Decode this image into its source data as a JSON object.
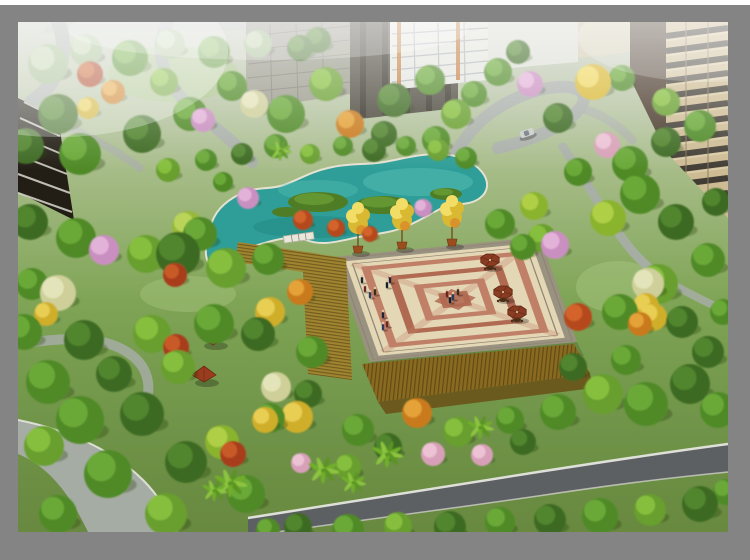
{
  "frame": {
    "background": "#ffffff",
    "matte": "#848484"
  },
  "scene": {
    "palette": {
      "baseTop": "#c6cabe",
      "baseHigh": "#a8bd8a",
      "baseMid": "#7fa455",
      "baseLow": "#6f9348",
      "baseBot": "#68893f",
      "lawn": "#a6c47e",
      "road": "#a9aeaa",
      "roadLight": "#b8bcb6",
      "asphalt": "#5d6062",
      "curb": "#e6e6e0",
      "pond": "#2f9e98",
      "pondLight": "#55bdb4",
      "pondDark": "#1d807c",
      "pondRim": "#e5e2d2",
      "lily": "#4e7d26",
      "lilyLite": "#6a9c34",
      "plazaStep": "#9a9280",
      "plazaCream": "#e4d7b6",
      "plazaRed": "#c08068",
      "plazaRed2": "#b06a52",
      "plazaLine": "#8e8571",
      "woodDeck": "#a08430",
      "woodLine": "#63511a",
      "pergola": "#8a6a20",
      "pergolaLine": "#4f3d0f",
      "pot": "#9a4e1e",
      "potRim": "#6e3512",
      "trunk": "#6b4a14",
      "umbrella": "#8a3c22",
      "umbrellaRib": "#5e2814",
      "table": "#4a2e16",
      "gazebo": "#9a3c1e",
      "gazeboLine": "#6e2812",
      "bldgDarkL": "#221e15",
      "bldgSlab": "#cfcfc5",
      "bldgGray": "#8e8a80",
      "bldgGrayLine": "#6a665e",
      "bldgDark": "#413c32",
      "bldgDarkStripe": "#2e2a22",
      "bldgWhite": "#e4e4de",
      "bldgWin": "#98a0a6",
      "bldgOrange": "#c07434",
      "towerSide": "#4a3a2c",
      "towerFace": "#cdbb94",
      "towerRow": "#33302a",
      "towerTrim": "#8a7a5c",
      "towerSlab": "#ddd0ac",
      "carBody": "#c9cdc9",
      "carGlass": "#6a7078",
      "shadow": "#1e3a12",
      "bananaA": "#6fae2a",
      "bananaB": "#8cc43f",
      "bananaC": "#5a9422",
      "skinTone": "#e0c4a4"
    },
    "treeColors": {
      "g1": [
        "#3c6b22",
        "#55892f"
      ],
      "g2": [
        "#4f8a28",
        "#6fae39"
      ],
      "g3": [
        "#679f2d",
        "#8cc43f"
      ],
      "yg": [
        "#8ab32e",
        "#b5d44a"
      ],
      "pale": [
        "#9fb98a",
        "#c6d6b0"
      ],
      "red": [
        "#a83c1a",
        "#cc5f2a"
      ],
      "red2": [
        "#b5481e",
        "#d86a2e"
      ],
      "org": [
        "#c97a1e",
        "#e9a93c"
      ],
      "yel": [
        "#cfae2a",
        "#ecd45a"
      ],
      "gink": [
        "#d9b832",
        "#f2dd66"
      ],
      "pnk": [
        "#c98fc0",
        "#e7b9dd"
      ],
      "pnk2": [
        "#d8a0b8",
        "#f0c8d8"
      ],
      "ply": [
        "#cfcf9a",
        "#e8e8c0"
      ],
      "wil": [
        "#97b83a",
        "#c0d860"
      ]
    },
    "trees": [
      [
        30,
        42,
        20,
        "pale"
      ],
      [
        68,
        28,
        16,
        "pale"
      ],
      [
        112,
        36,
        18,
        "g2"
      ],
      [
        152,
        22,
        15,
        "pale"
      ],
      [
        196,
        30,
        16,
        "g2"
      ],
      [
        240,
        22,
        14,
        "pale"
      ],
      [
        282,
        26,
        13,
        "g1"
      ],
      [
        300,
        18,
        13,
        "g1"
      ],
      [
        72,
        52,
        13,
        "red"
      ],
      [
        95,
        70,
        12,
        "org"
      ],
      [
        70,
        86,
        11,
        "yel"
      ],
      [
        146,
        60,
        14,
        "g3"
      ],
      [
        40,
        92,
        20,
        "g1"
      ],
      [
        8,
        124,
        18,
        "g1"
      ],
      [
        62,
        132,
        21,
        "g2"
      ],
      [
        124,
        112,
        19,
        "g1"
      ],
      [
        172,
        92,
        17,
        "g2"
      ],
      [
        214,
        64,
        15,
        "g2"
      ],
      [
        185,
        98,
        12,
        "pnk"
      ],
      [
        236,
        82,
        14,
        "ply"
      ],
      [
        268,
        92,
        19,
        "g2"
      ],
      [
        308,
        62,
        17,
        "g3"
      ],
      [
        332,
        102,
        14,
        "org"
      ],
      [
        376,
        78,
        17,
        "g1"
      ],
      [
        412,
        58,
        15,
        "g2"
      ],
      [
        438,
        92,
        15,
        "g3"
      ],
      [
        456,
        72,
        13,
        "g2"
      ],
      [
        480,
        50,
        14,
        "g2"
      ],
      [
        500,
        30,
        12,
        "g1"
      ],
      [
        418,
        118,
        14,
        "g2"
      ],
      [
        366,
        112,
        13,
        "g1"
      ],
      [
        512,
        62,
        13,
        "pnk"
      ],
      [
        575,
        60,
        18,
        "gink"
      ],
      [
        540,
        96,
        15,
        "g1"
      ],
      [
        604,
        56,
        13,
        "g2"
      ],
      [
        648,
        80,
        14,
        "g3"
      ],
      [
        589,
        123,
        13,
        "pnk2"
      ],
      [
        612,
        142,
        18,
        "g2"
      ],
      [
        648,
        120,
        15,
        "g1"
      ],
      [
        682,
        104,
        16,
        "g2"
      ],
      [
        698,
        180,
        14,
        "g1"
      ],
      [
        560,
        150,
        14,
        "g2"
      ],
      [
        622,
        172,
        20,
        "g2"
      ],
      [
        658,
        200,
        18,
        "g1"
      ],
      [
        690,
        238,
        17,
        "g2"
      ],
      [
        640,
        262,
        20,
        "g3"
      ],
      [
        602,
        290,
        18,
        "g2"
      ],
      [
        664,
        300,
        16,
        "g1"
      ],
      [
        590,
        196,
        18,
        "yg"
      ],
      [
        537,
        223,
        14,
        "pnk"
      ],
      [
        560,
        295,
        14,
        "red2"
      ],
      [
        635,
        295,
        14,
        "yel"
      ],
      [
        630,
        262,
        16,
        "ply"
      ],
      [
        628,
        284,
        13,
        "yel"
      ],
      [
        622,
        302,
        12,
        "org"
      ],
      [
        690,
        330,
        16,
        "g1"
      ],
      [
        705,
        290,
        13,
        "g2"
      ],
      [
        12,
        200,
        18,
        "g1"
      ],
      [
        58,
        216,
        20,
        "g2"
      ],
      [
        128,
        232,
        19,
        "g3"
      ],
      [
        182,
        212,
        17,
        "g2"
      ],
      [
        86,
        228,
        15,
        "pnk"
      ],
      [
        40,
        271,
        18,
        "ply"
      ],
      [
        28,
        292,
        12,
        "yel"
      ],
      [
        157,
        253,
        12,
        "red"
      ],
      [
        14,
        262,
        16,
        "g2"
      ],
      [
        6,
        310,
        18,
        "g2"
      ],
      [
        66,
        318,
        20,
        "g1"
      ],
      [
        134,
        312,
        19,
        "g3"
      ],
      [
        196,
        302,
        20,
        "g2"
      ],
      [
        252,
        290,
        15,
        "yel"
      ],
      [
        282,
        270,
        13,
        "org"
      ],
      [
        240,
        312,
        17,
        "g1"
      ],
      [
        294,
        330,
        16,
        "g2"
      ],
      [
        30,
        360,
        22,
        "g2"
      ],
      [
        96,
        352,
        18,
        "g1"
      ],
      [
        160,
        345,
        17,
        "g3"
      ],
      [
        158,
        325,
        13,
        "red"
      ],
      [
        150,
        148,
        12,
        "g3"
      ],
      [
        188,
        138,
        11,
        "g2"
      ],
      [
        224,
        132,
        11,
        "g1"
      ],
      [
        258,
        124,
        12,
        "g2"
      ],
      [
        292,
        132,
        10,
        "g3"
      ],
      [
        325,
        124,
        10,
        "g2"
      ],
      [
        356,
        128,
        12,
        "g1"
      ],
      [
        388,
        124,
        10,
        "g2"
      ],
      [
        420,
        128,
        11,
        "g3"
      ],
      [
        448,
        136,
        11,
        "g2"
      ],
      [
        205,
        160,
        10,
        "g2"
      ],
      [
        170,
        205,
        16,
        "wil"
      ],
      [
        230,
        176,
        11,
        "pnk"
      ],
      [
        405,
        186,
        9,
        "pnk"
      ],
      [
        285,
        198,
        10,
        "red2"
      ],
      [
        318,
        206,
        9,
        "red2"
      ],
      [
        352,
        212,
        8,
        "red2"
      ],
      [
        160,
        232,
        22,
        "g1"
      ],
      [
        208,
        246,
        20,
        "g3"
      ],
      [
        250,
        237,
        16,
        "g2"
      ],
      [
        482,
        202,
        15,
        "g2"
      ],
      [
        516,
        184,
        14,
        "yg"
      ],
      [
        524,
        216,
        14,
        "g3"
      ],
      [
        505,
        225,
        13,
        "g2"
      ],
      [
        62,
        398,
        24,
        "g2"
      ],
      [
        124,
        392,
        22,
        "g1"
      ],
      [
        26,
        424,
        20,
        "g3"
      ],
      [
        90,
        452,
        24,
        "g2"
      ],
      [
        168,
        440,
        21,
        "g1"
      ],
      [
        40,
        492,
        19,
        "g2"
      ],
      [
        148,
        492,
        21,
        "g3"
      ],
      [
        228,
        472,
        19,
        "g2"
      ],
      [
        204,
        420,
        17,
        "yg"
      ],
      [
        252,
        396,
        15,
        "g2"
      ],
      [
        290,
        372,
        14,
        "g1"
      ],
      [
        258,
        365,
        15,
        "ply"
      ],
      [
        247,
        398,
        13,
        "yel"
      ],
      [
        215,
        432,
        13,
        "red"
      ],
      [
        283,
        441,
        10,
        "pnk2"
      ],
      [
        415,
        432,
        12,
        "pnk2"
      ],
      [
        464,
        433,
        11,
        "pnk2"
      ],
      [
        279,
        395,
        16,
        "yel"
      ],
      [
        399,
        391,
        15,
        "org"
      ],
      [
        340,
        408,
        16,
        "g2"
      ],
      [
        370,
        425,
        14,
        "g1"
      ],
      [
        440,
        410,
        15,
        "g3"
      ],
      [
        492,
        398,
        14,
        "g2"
      ],
      [
        330,
        445,
        13,
        "g3"
      ],
      [
        505,
        420,
        13,
        "g1"
      ],
      [
        540,
        390,
        18,
        "g2"
      ],
      [
        585,
        372,
        20,
        "g3"
      ],
      [
        628,
        382,
        22,
        "g2"
      ],
      [
        672,
        362,
        20,
        "g1"
      ],
      [
        700,
        388,
        18,
        "g2"
      ],
      [
        555,
        345,
        14,
        "g1"
      ],
      [
        608,
        338,
        15,
        "g2"
      ],
      [
        280,
        505,
        14,
        "g1"
      ],
      [
        330,
        508,
        16,
        "g2"
      ],
      [
        380,
        504,
        14,
        "g3"
      ],
      [
        432,
        505,
        16,
        "g1"
      ],
      [
        482,
        500,
        15,
        "g2"
      ],
      [
        532,
        498,
        16,
        "g1"
      ],
      [
        582,
        494,
        18,
        "g2"
      ],
      [
        632,
        488,
        16,
        "g3"
      ],
      [
        682,
        482,
        18,
        "g1"
      ],
      [
        708,
        470,
        13,
        "g2"
      ],
      [
        250,
        508,
        12,
        "g2"
      ]
    ],
    "bananas": [
      [
        212,
        463,
        16
      ],
      [
        305,
        450,
        15
      ],
      [
        369,
        434,
        15
      ],
      [
        462,
        407,
        13
      ],
      [
        262,
        130,
        11
      ],
      [
        196,
        470,
        12
      ],
      [
        335,
        462,
        12
      ]
    ],
    "people": [
      [
        344,
        261
      ],
      [
        347,
        270
      ],
      [
        352,
        276
      ],
      [
        357,
        273
      ],
      [
        369,
        266
      ],
      [
        372,
        261
      ],
      [
        429,
        275
      ],
      [
        435,
        278
      ],
      [
        440,
        273
      ],
      [
        432,
        281
      ],
      [
        365,
        296
      ],
      [
        369,
        305
      ],
      [
        365,
        308
      ]
    ],
    "peopleColors": [
      "#1d2532",
      "#6e2420",
      "#2a3a5a",
      "#3a2e1a",
      "#14202c"
    ],
    "umbrellas": [
      [
        472,
        238
      ],
      [
        485,
        270
      ],
      [
        499,
        290
      ]
    ],
    "pottedTrees": [
      [
        340,
        224
      ],
      [
        384,
        220
      ],
      [
        434,
        217
      ]
    ],
    "gazebos": [
      [
        195,
        314
      ],
      [
        186,
        351
      ]
    ],
    "car": {
      "x": 509,
      "y": 111,
      "angle": -18
    }
  }
}
